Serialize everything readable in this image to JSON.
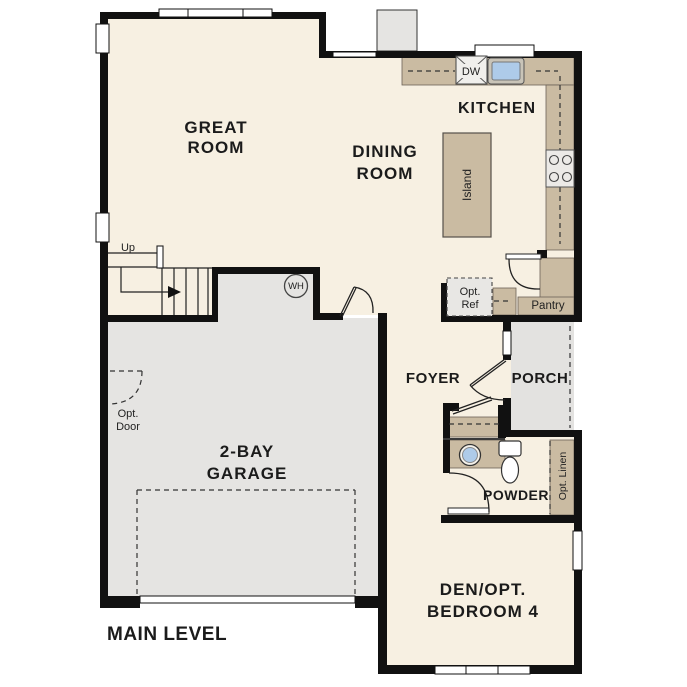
{
  "title": "MAIN LEVEL",
  "rooms": {
    "great_room": {
      "line1": "GREAT",
      "line2": "ROOM"
    },
    "dining_room": {
      "line1": "DINING",
      "line2": "ROOM"
    },
    "kitchen": {
      "label": "KITCHEN"
    },
    "foyer": {
      "label": "FOYER"
    },
    "porch": {
      "label": "PORCH"
    },
    "powder": {
      "label": "POWDER"
    },
    "den": {
      "line1": "DEN/OPT.",
      "line2": "BEDROOM 4"
    },
    "garage": {
      "line1": "2-BAY",
      "line2": "GARAGE"
    }
  },
  "features": {
    "island": "Island",
    "pantry": "Pantry",
    "dishwasher": "DW",
    "water_heater": "WH",
    "stairs_up": "Up",
    "opt_ref": {
      "line1": "Opt.",
      "line2": "Ref"
    },
    "opt_door": {
      "line1": "Opt.",
      "line2": "Door"
    },
    "opt_linen": "Opt. Linen"
  },
  "colors": {
    "floor": "#f7f0e2",
    "garage_floor": "#e5e4e2",
    "counter": "#cabba2",
    "wall": "#111111",
    "sink_blue": "#aecbe9",
    "window": "#ffffff",
    "opt_ref_fill": "#e8e7e4"
  }
}
